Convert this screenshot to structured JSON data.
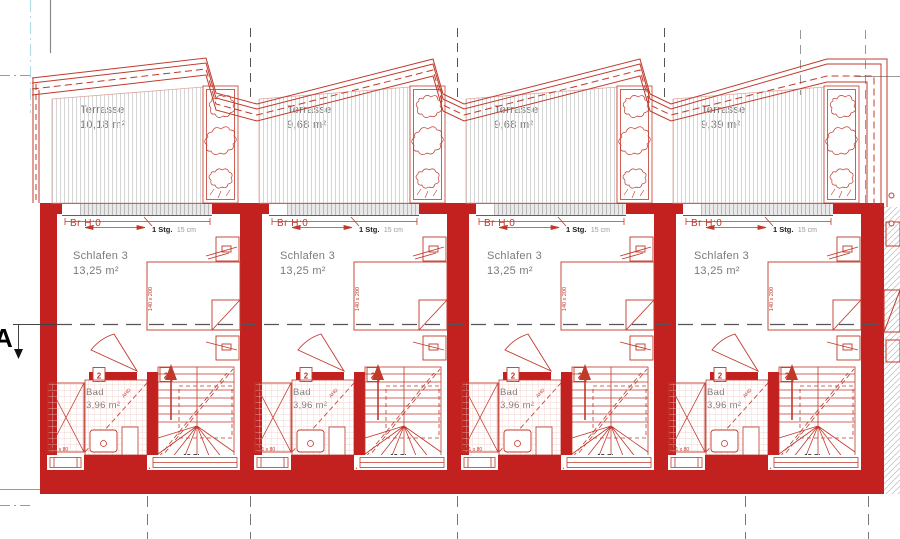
{
  "drawing": {
    "section_marker": "A",
    "units": [
      {
        "terrace": {
          "label": "Terrasse",
          "area": "10,18 m²"
        }
      },
      {
        "terrace": {
          "label": "Terrasse",
          "area": "9,68 m²"
        }
      },
      {
        "terrace": {
          "label": "Terrasse",
          "area": "9,68 m²"
        }
      },
      {
        "terrace": {
          "label": "Terrasse",
          "area": "9,39 m²"
        }
      }
    ],
    "unit_common": {
      "door": {
        "br": "Br H:0",
        "stg": "1 Stg.",
        "stg_note": "15 cm"
      },
      "bedroom": {
        "label": "Schlafen 3",
        "area": "13,25 m²",
        "bed_dim": "140 x 200"
      },
      "bath": {
        "label": "Bad",
        "area": "3,96 m²",
        "shower_dim": "161 x 80",
        "tag": "2",
        "diagonal_note": "AHD"
      },
      "stairs": {
        "label": "15 Stg.",
        "ratio": "20/25"
      }
    },
    "colors": {
      "wall_red": "#c32120",
      "line_red": "#c0392b",
      "text_gray": "#7a7a7a",
      "grid_dark": "#555555",
      "grid_gray": "#999999",
      "grid_blue": "#b5dce6",
      "hatch_gray": "#d6d6d6",
      "tile_pink": "#eec7c3"
    }
  }
}
